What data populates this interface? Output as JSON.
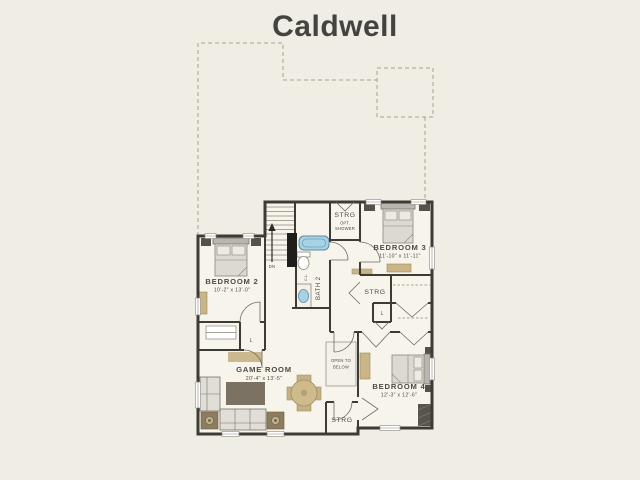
{
  "title": "Caldwell",
  "colors": {
    "background": "#efede4",
    "plan_floor": "#f6f4eb",
    "walls": "#3e3b36",
    "roofline_dash": "#a5a196",
    "fixture_blue": "#a6d2e6",
    "wood_tan": "#c9b586",
    "text": "#4e4a44"
  },
  "rooms": {
    "bedroom2": {
      "label": "BEDROOM 2",
      "dims": "10'-2\" x 13'-0\""
    },
    "bedroom3": {
      "label": "BEDROOM 3",
      "dims": "11'-10\" x 11'-11\""
    },
    "bedroom4": {
      "label": "BEDROOM 4",
      "dims": "12'-3\" x 12'-6\""
    },
    "game_room": {
      "label": "GAME ROOM",
      "dims": "20'-4\" x 13'-5\""
    },
    "bath2": {
      "label": "BATH 2",
      "closet": "C.L."
    },
    "storage_top": {
      "label": "STRG",
      "option_line1": "OPT.",
      "option_line2": "SHOWER"
    },
    "storage_mid": {
      "label": "STRG"
    },
    "storage_bottom": {
      "label": "STRG"
    },
    "open_to_below": {
      "line1": "OPEN TO",
      "line2": "BELOW"
    },
    "linen_left": {
      "label": "L"
    },
    "linen_right": {
      "label": "L"
    },
    "stairs": {
      "label": "DN"
    }
  }
}
